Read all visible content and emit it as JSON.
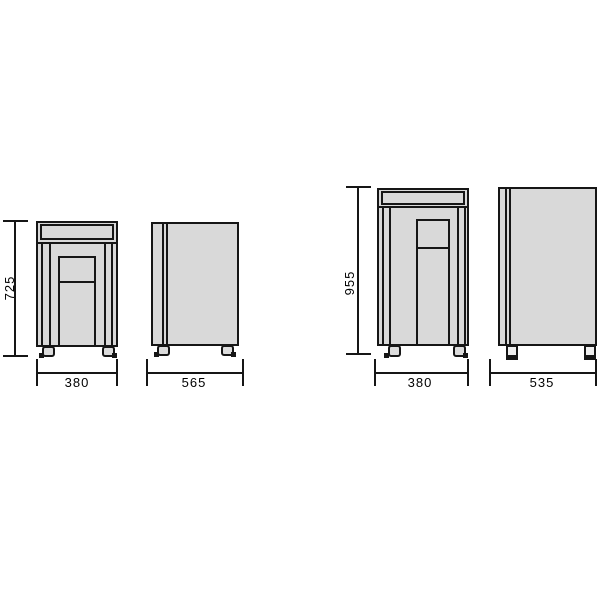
{
  "dimensions": {
    "machine1": {
      "height": "725",
      "front_width": "380",
      "side_depth": "565"
    },
    "machine2": {
      "height": "955",
      "front_width": "380",
      "side_depth": "535"
    }
  },
  "colors": {
    "body_fill": "#d9d9d9",
    "line_color": "#161616",
    "background": "#ffffff"
  }
}
